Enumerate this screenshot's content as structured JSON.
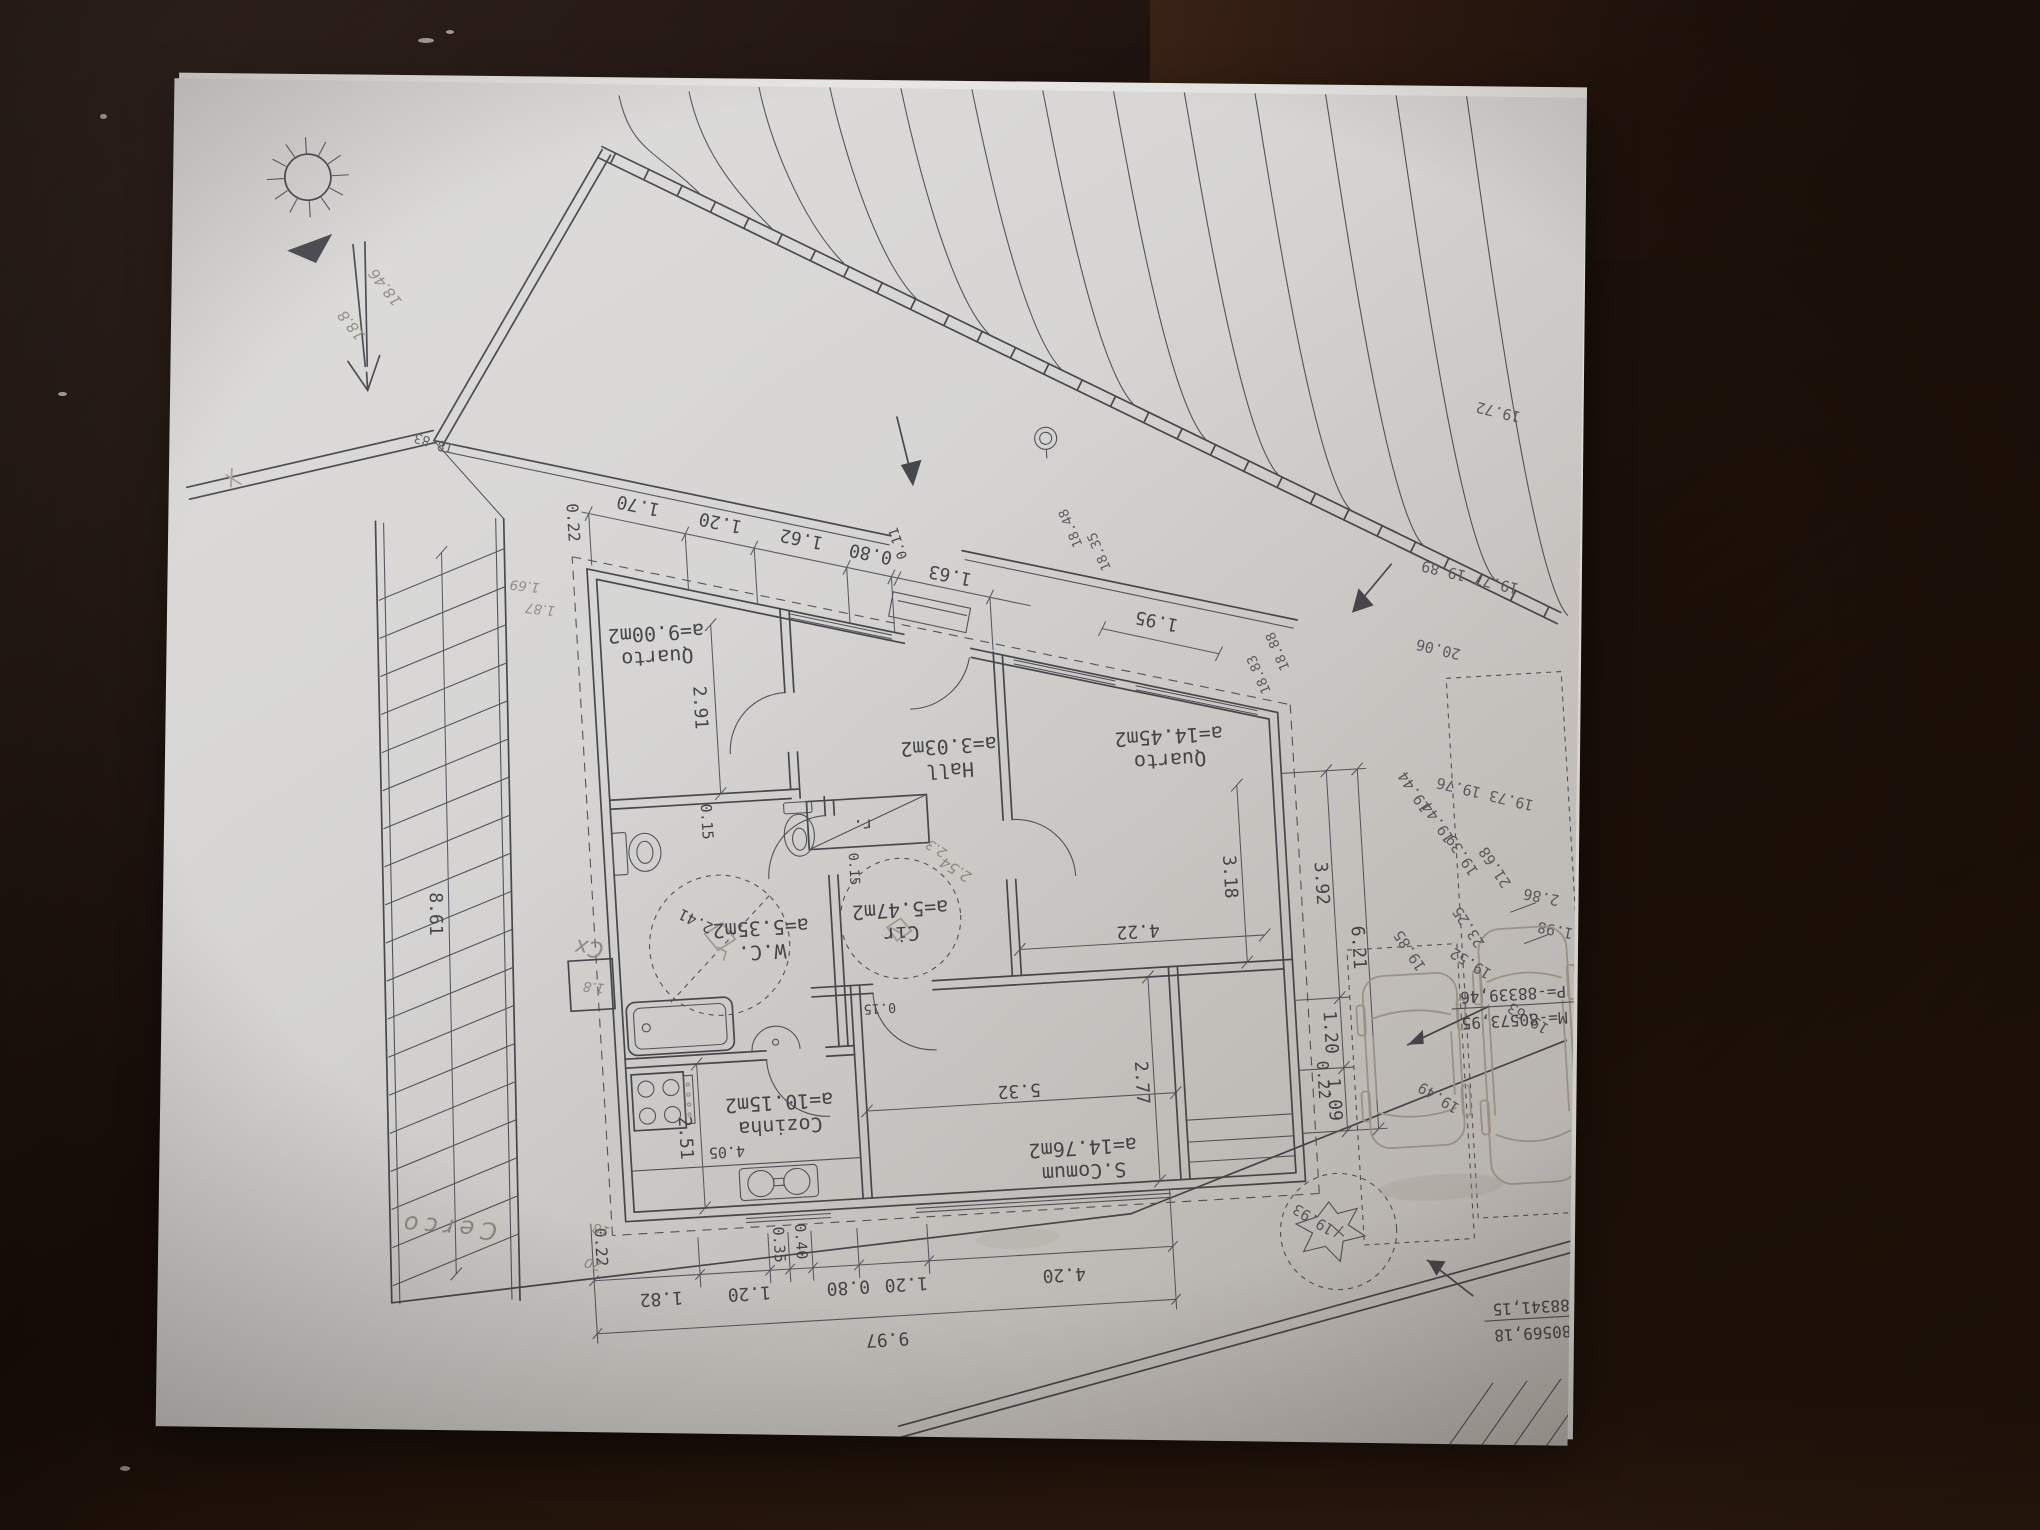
{
  "scene": {
    "type": "photograph of architectural floor plan on wooden table, drawing upside down"
  },
  "plan": {
    "rooms": [
      {
        "name": "Quarto",
        "area": "a=9.00m2"
      },
      {
        "name": "Hall",
        "area": "a=3.03m2"
      },
      {
        "name": "W.C.",
        "area": "a=5.35m2"
      },
      {
        "name": "Cir",
        "area": "a=5.47m2"
      },
      {
        "name": "Quarto",
        "area": "a=14.45m2"
      },
      {
        "name": "Cozinha",
        "area": "a=10.15m2"
      },
      {
        "name": "S.Comum",
        "area": "a=14.76m2"
      }
    ],
    "closet_label": "r.",
    "dims": {
      "top": [
        "1.70",
        "1.20",
        "1.62",
        "0.80",
        "0.11",
        "1.63",
        "1.95"
      ],
      "eaves": [
        "0.22",
        "0.22"
      ],
      "left": [
        "2.91",
        "0.15",
        "8.61"
      ],
      "wc": [
        "2.41"
      ],
      "inner": [
        "0.15",
        "0.15"
      ],
      "kitchen": [
        "2.51",
        "4.05"
      ],
      "scomum": [
        "5.32",
        "2.77"
      ],
      "quarto2": [
        "3.18",
        "4.22"
      ],
      "right": [
        "3.92",
        "1.20",
        "1.09",
        "6.21",
        "0.22"
      ],
      "bottom": [
        "1.82",
        "1.20",
        "0.35",
        "0.40",
        "0.80",
        "1.20",
        "4.20",
        "9.97"
      ],
      "site": [
        "2.86",
        "1.98"
      ]
    },
    "levels": {
      "topleft": [
        "18.83",
        "18.46",
        "18.8"
      ],
      "front": [
        "18.48",
        "18.35",
        "18.83",
        "18.88"
      ],
      "terrain": [
        "19.72",
        "19.77 19.89",
        "20.06",
        "19.73 19.76"
      ],
      "yard": [
        "19.44",
        "19.44",
        "19.39",
        "19.52",
        "19.49",
        "19.63",
        "19.85",
        "21.68",
        "23.25",
        "19.93"
      ]
    },
    "pencil": {
      "box": "Cx",
      "box_dim": "1.8",
      "fence": "Cerco",
      "marks": [
        "18",
        "20",
        "1.69",
        "1.87",
        "2.54",
        "2.3"
      ]
    },
    "survey_points": [
      {
        "p": "P=-88339,46",
        "m": "M=-80573,95"
      },
      {
        "p": "P=-88341,15",
        "m": "M=-80569,18"
      }
    ]
  }
}
